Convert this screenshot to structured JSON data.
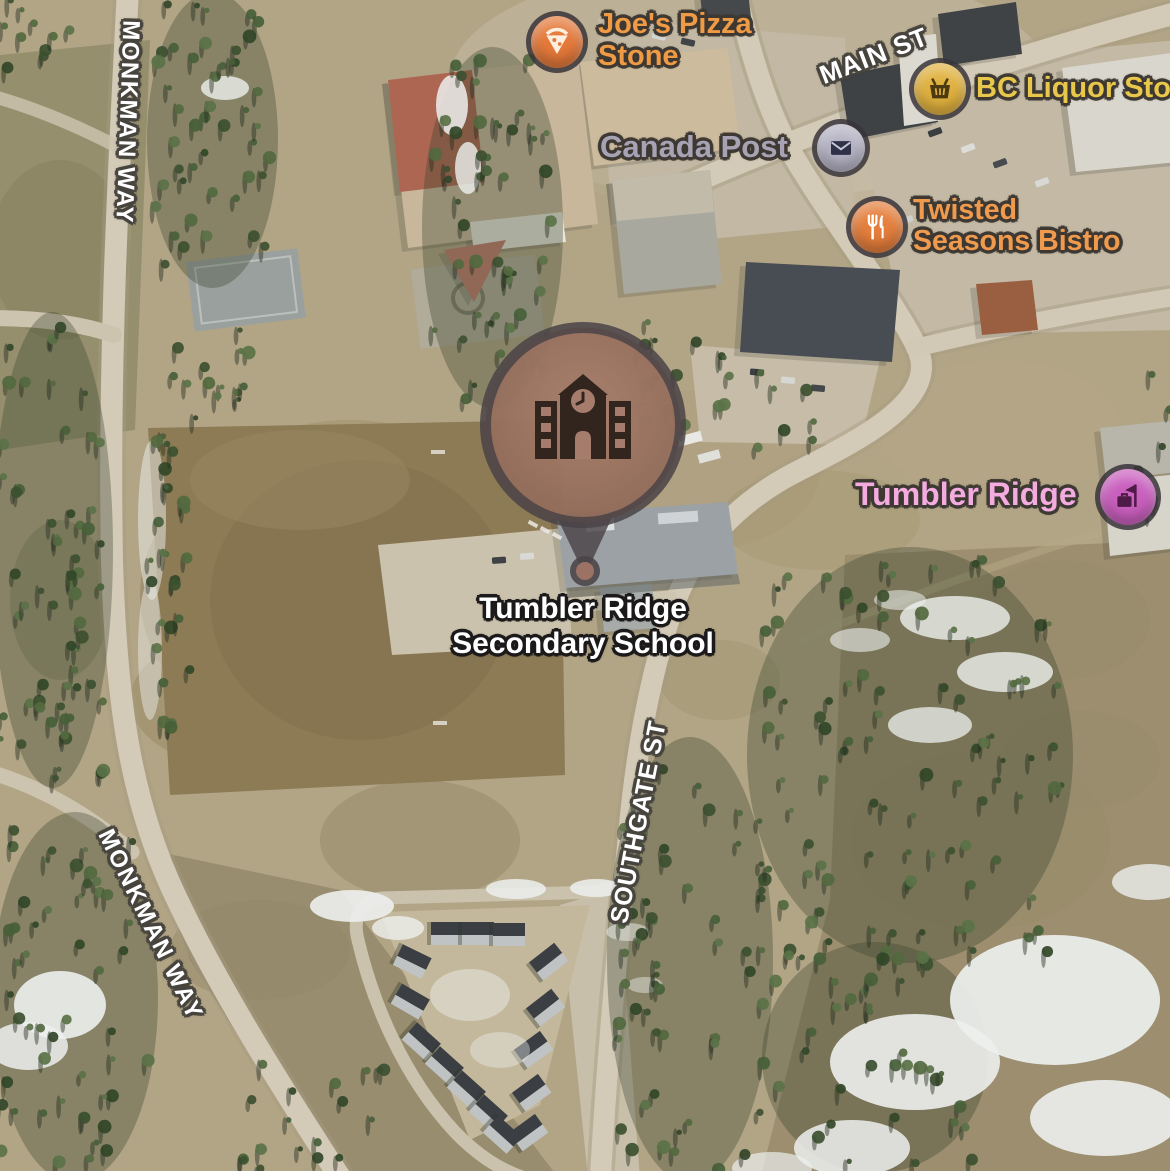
{
  "map": {
    "title": "Tumbler Ridge satellite map",
    "view": "satellite",
    "selected_place": {
      "name": "Tumbler Ridge Secondary School",
      "name_line1": "Tumbler Ridge",
      "name_line2": "Secondary School",
      "marker_icon": "school-icon",
      "marker_color": "#9b7263",
      "marker_ring_color": "#4a4347",
      "label_color": "#ffffff"
    },
    "poi_labels": [
      {
        "id": "joes-pizza-stone",
        "line1": "Joe's Pizza",
        "line2": "Stone",
        "icon": "pizza-icon",
        "text_color": "#ef9a45",
        "icon_color": "#e5793a"
      },
      {
        "id": "canada-post",
        "label": "Canada Post",
        "icon": "mail-icon",
        "text_color": "#a8a3b4",
        "icon_color": "#b5b3c4"
      },
      {
        "id": "bc-liquor-store",
        "label": "BC Liquor Sto",
        "icon": "shopping-basket-icon",
        "text_color": "#e9c74b",
        "icon_color": "#e0b13e"
      },
      {
        "id": "twisted-seasons-bistro",
        "line1": "Twisted",
        "line2": "Seasons Bistro",
        "icon": "restaurant-icon",
        "text_color": "#f09a4e",
        "icon_color": "#e57e3c"
      },
      {
        "id": "tumbler-ridge-town",
        "label": "Tumbler Ridge",
        "icon": "town-icon",
        "text_color": "#f3abe0",
        "icon_color": "#c95fbe"
      }
    ],
    "road_labels": [
      {
        "id": "monkman-way-north",
        "label": "MONKMAN WAY"
      },
      {
        "id": "monkman-way-south",
        "label": "MONKMAN WAY"
      },
      {
        "id": "main-st",
        "label": "MAIN ST"
      },
      {
        "id": "southgate-st",
        "label": "SOUTHGATE ST"
      }
    ]
  }
}
